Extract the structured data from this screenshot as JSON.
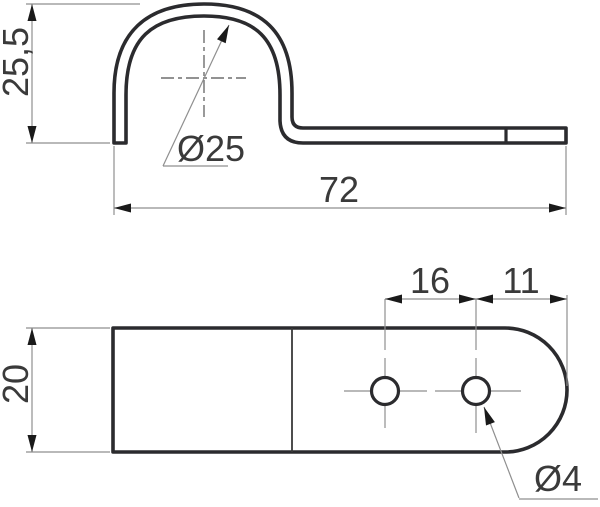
{
  "drawing": {
    "type": "technical-drawing",
    "part": "one-hole pipe clip",
    "background": "#ffffff",
    "colors": {
      "outline": "#2b2b2e",
      "dimension_lines": "#8f8f8f",
      "arrowheads": "#1a1a1a",
      "text": "#3a3a3a"
    },
    "side_view": {
      "height_label": "25,5",
      "pipe_diameter_label": "Ø25",
      "length_label": "72"
    },
    "plan_view": {
      "width_label": "20",
      "hole_spacing_label": "16",
      "hole_to_end_label": "11",
      "hole_diameter_label": "Ø4"
    }
  }
}
